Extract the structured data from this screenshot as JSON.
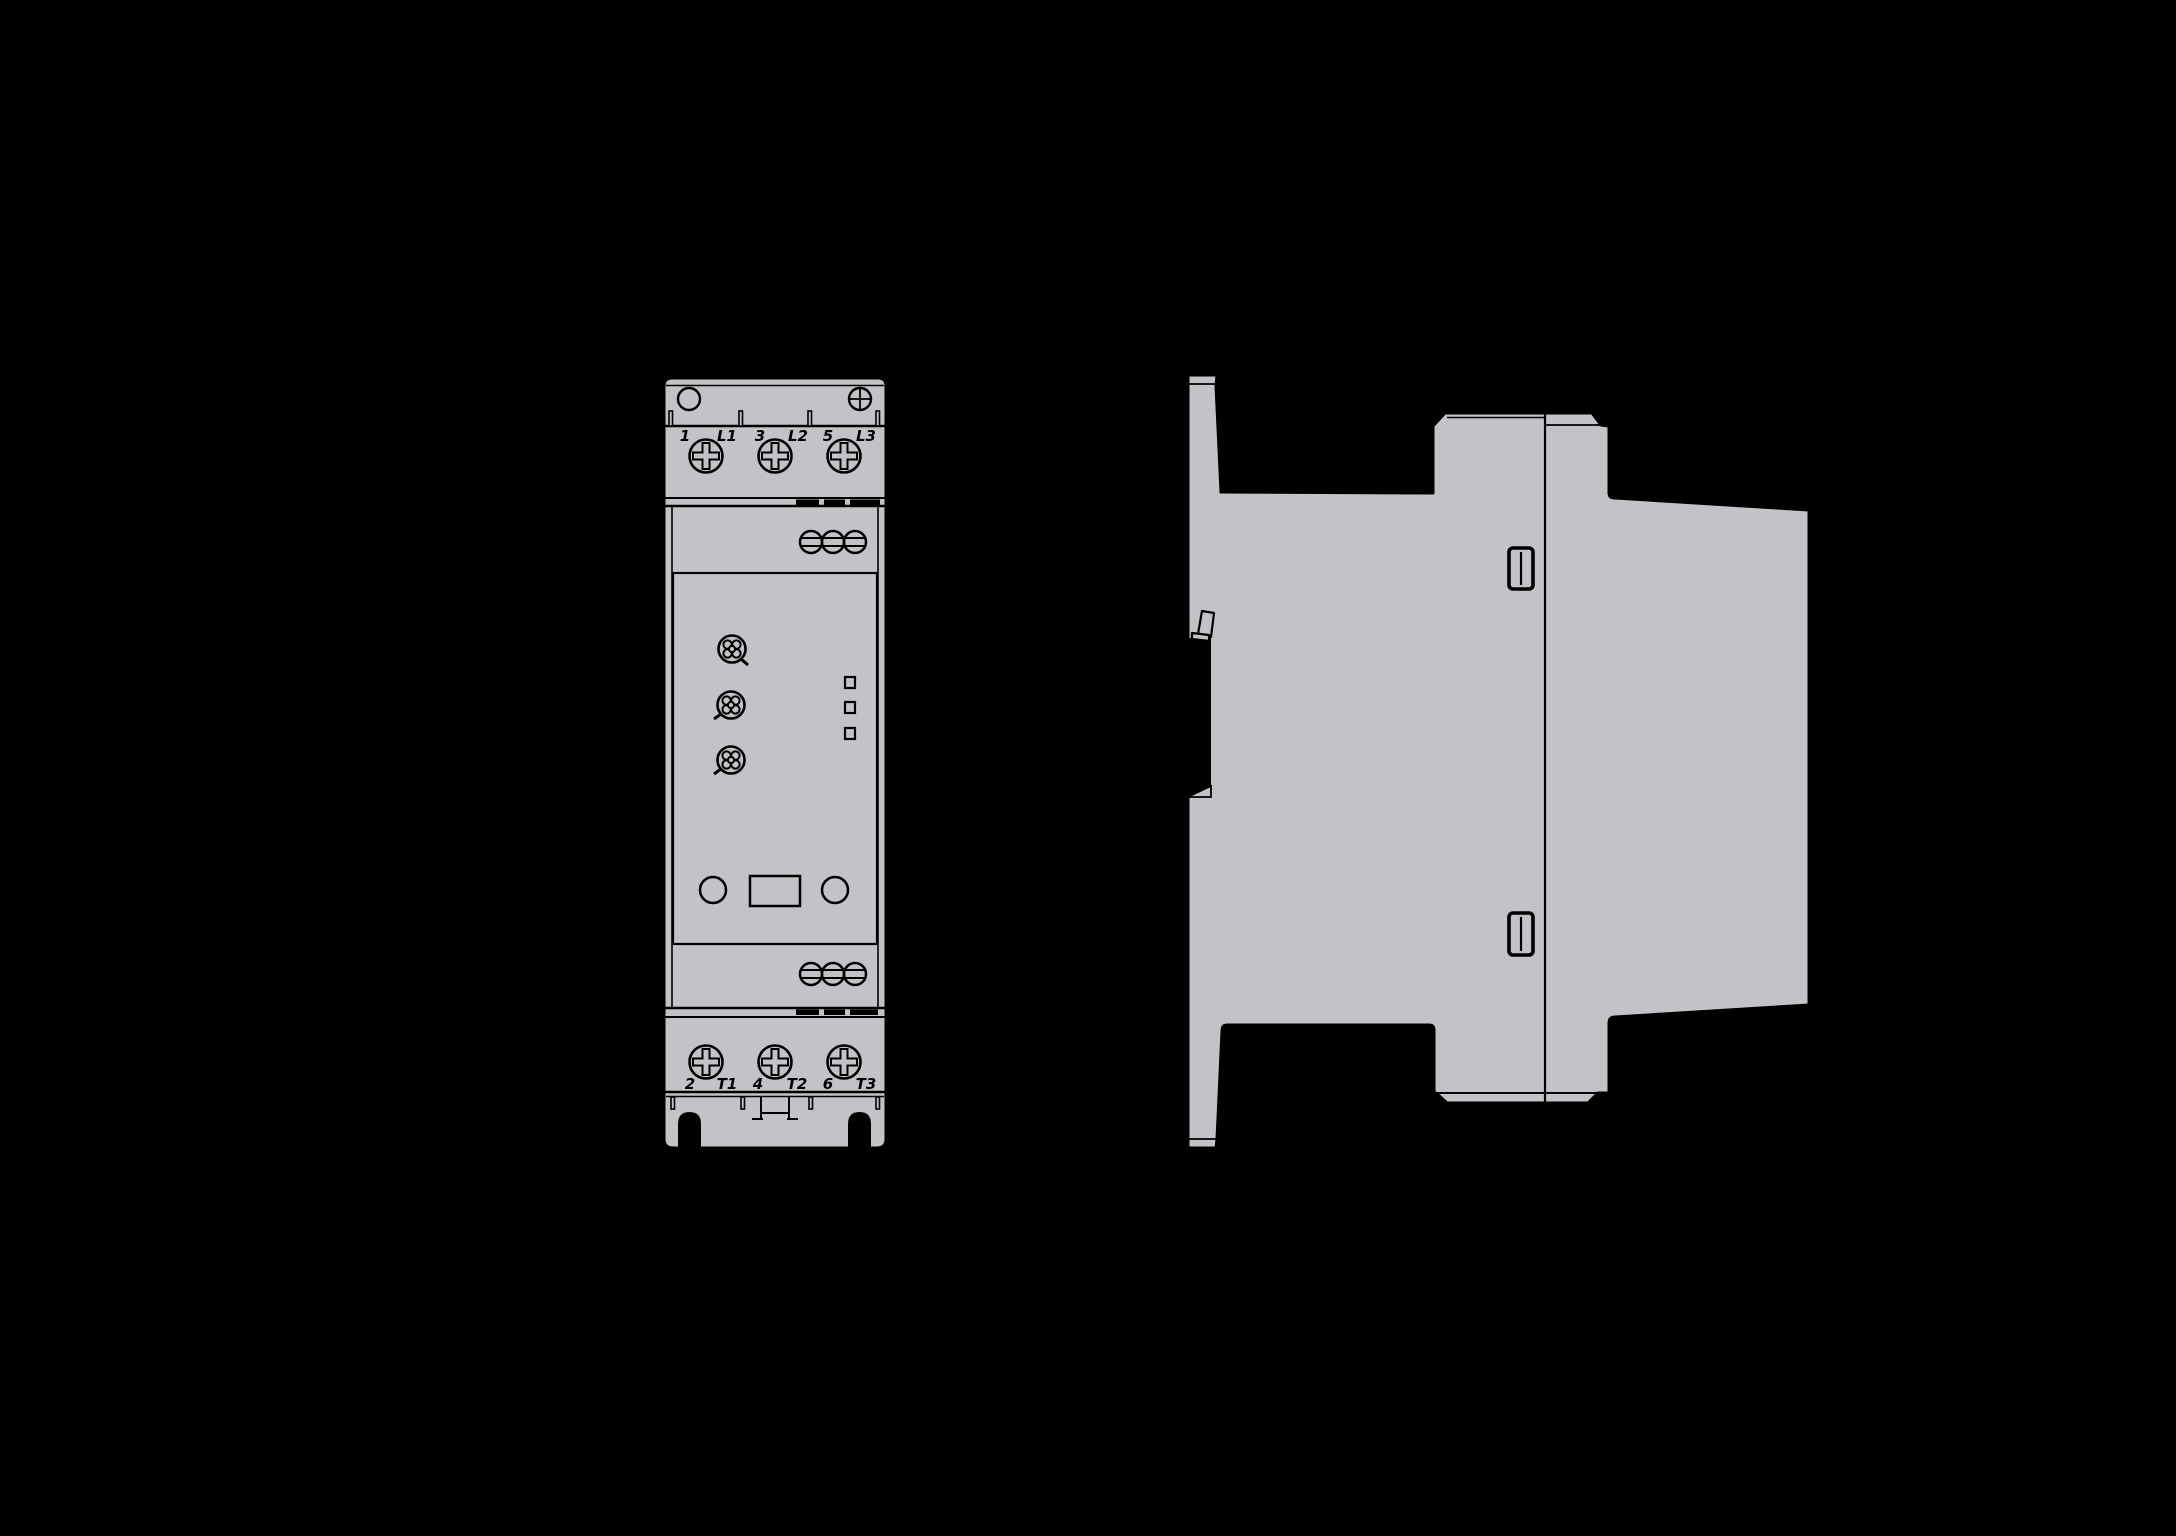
{
  "front_view": {
    "top_terminal_labels": [
      "1",
      "L1",
      "3",
      "L2",
      "5",
      "L3"
    ],
    "bottom_terminal_labels": [
      "2",
      "T1",
      "4",
      "T2",
      "6",
      "T3"
    ]
  },
  "colors": {
    "background": "#000000",
    "device_fill": "#c2c3c7",
    "outline": "#000000",
    "recess_fill": "#000000"
  }
}
